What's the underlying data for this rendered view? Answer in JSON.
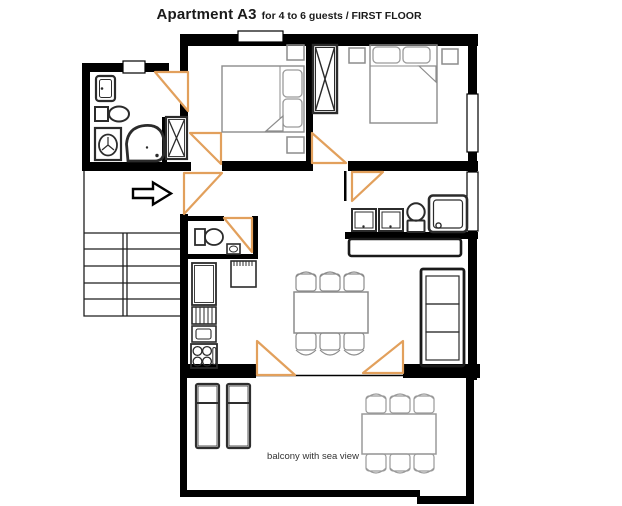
{
  "title": {
    "apartment": "Apartment A3",
    "details": "for 4 to 6 guests / FIRST FLOOR"
  },
  "balcony": {
    "caption": "balcony with sea view"
  },
  "colors": {
    "wall": "#000000",
    "door": "#e2a05c",
    "fixture": "#2b2b2b",
    "furniture": "#8c8c8c",
    "lightfurn": "#9a9a9a",
    "stairs": "#1f1f1f",
    "text": "#1a1a1a",
    "background": "#ffffff"
  }
}
